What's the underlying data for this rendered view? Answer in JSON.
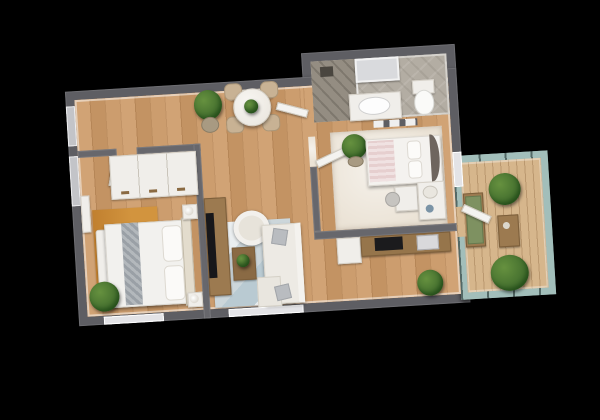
{
  "scene": {
    "label": "apartment-3d-floorplan-render",
    "view": "top-down-3d",
    "background": "#000000"
  },
  "colors": {
    "background": "#000000",
    "wall": "#5e5e63",
    "wood_floor": "#c99a6b",
    "balcony_deck": "#d6b68c",
    "kids_carpet": "#ebe3d6",
    "bathroom_stone": "#b3ada3",
    "living_rug": "#ccd6da",
    "bedroom_rug": "#d2943e",
    "sofa": "#edeae4",
    "plant_green": "#47722f",
    "railing_glass": "#9cb6b2",
    "bench_cushion": "#7e9161",
    "tv_screen": "#17171a"
  },
  "rooms": [
    {
      "name": "entry-dining-hall",
      "floor": "oak-wood",
      "furniture": [
        "round-marble-dining-table",
        "dining-chair-1",
        "dining-chair-2",
        "dining-chair-3",
        "dining-chair-4",
        "tall-potted-plant",
        "wall-shelf-with-tableware",
        "table-centerpiece-plant"
      ]
    },
    {
      "name": "master-bedroom",
      "floor": "oak-wood",
      "furniture": [
        "sliding-door-wardrobe",
        "double-bed-white-duvet-gray-runner",
        "foot-bench",
        "nightstand-lamp-left",
        "nightstand-lamp-right",
        "amber-rug",
        "wall-shelf",
        "potted-plant",
        "window-left-1",
        "window-left-2",
        "window-bottom"
      ]
    },
    {
      "name": "living-room-with-kitchen",
      "floor": "oak-wood",
      "furniture": [
        "tv-sideboard",
        "tv-screen",
        "round-armchair",
        "corner-sofa-with-chaise",
        "gray-throw-pillows",
        "coffee-table-with-plant",
        "blue-gray-rug",
        "kitchen-counter",
        "cooktop",
        "kitchen-sink",
        "fridge",
        "potted-plant",
        "window-bottom",
        "balcony-door"
      ]
    },
    {
      "name": "kids-bedroom",
      "floor": "cream-carpet",
      "furniture": [
        "single-bed-pink-white",
        "rounded-headboard",
        "potted-plant",
        "desk",
        "desk-chair",
        "white-dresser",
        "wall-art-frames",
        "window-right"
      ]
    },
    {
      "name": "bathroom",
      "floor": "stone-tile",
      "furniture": [
        "walk-in-shower",
        "shower-glass-panel",
        "vanity-washbasin",
        "mirror",
        "toilet"
      ]
    },
    {
      "name": "balcony",
      "floor": "wood-deck",
      "furniture": [
        "glass-railing",
        "bench-green-cushion",
        "side-table",
        "potted-plant-top",
        "potted-plant-bottom"
      ]
    }
  ]
}
